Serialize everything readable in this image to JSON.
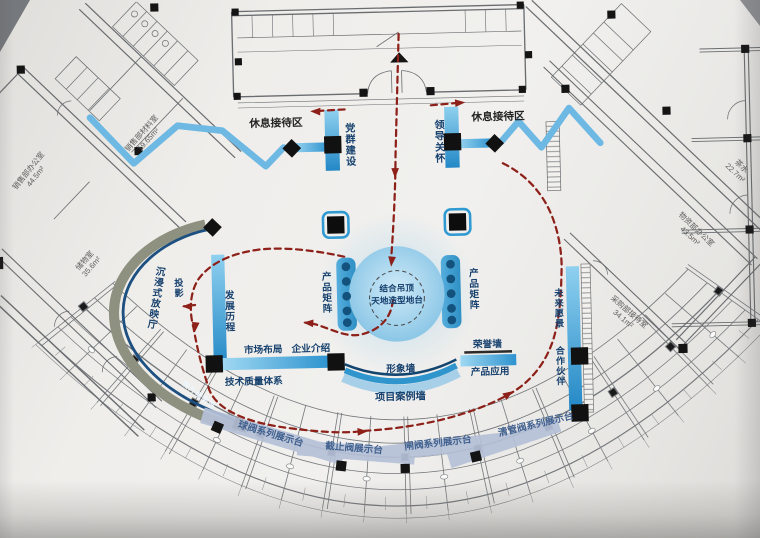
{
  "colors": {
    "accent_blue": "#2f99d4",
    "light_blue": "#a8cfe8",
    "navy_text": "#16406d",
    "route_red": "#8d2019",
    "stand_fill": "#b6c1d8",
    "band_gray": "#8e9180",
    "paper": "#efeeeb"
  },
  "zones": {
    "rest_left": "休息接待区",
    "rest_right": "休息接待区",
    "party_building": "党群建设",
    "leader_care": "领导关怀",
    "platform_line1": "结合吊顶",
    "platform_line2": "天地造型地台",
    "product_matrix_left": "产品矩阵",
    "product_matrix_right": "产品矩阵",
    "development_history": "发展历程",
    "market_layout": "市场布局",
    "company_intro": "企业介绍",
    "tech_quality": "技术质量体系",
    "image_wall": "形象墙",
    "project_case_wall": "项目案例墙",
    "honor_wall": "荣誉墙",
    "product_application": "产品应用",
    "future_vision": "未来愿景",
    "partners": "合作伙伴",
    "immersive_hall": "沉浸式放映厅",
    "projection": "投影",
    "photo_wall": "照片墙装饰"
  },
  "stands": [
    {
      "label": "球阀系列展示台"
    },
    {
      "label": "截止阀展示台"
    },
    {
      "label": "闸阀系列展示台"
    },
    {
      "label": "清管阀系列展示台"
    }
  ],
  "rooms": [
    {
      "name": "销售部材料室",
      "area": "19.65m²"
    },
    {
      "name": "销售部办公室",
      "area": "44.5m²"
    },
    {
      "name": "储物室",
      "area": "35.6m²"
    },
    {
      "name": "茶水",
      "area": "22.7m²"
    },
    {
      "name": "物资部办公室",
      "area": "43.5m²"
    },
    {
      "name": "采购部接待室",
      "area": "34.1m²"
    }
  ]
}
